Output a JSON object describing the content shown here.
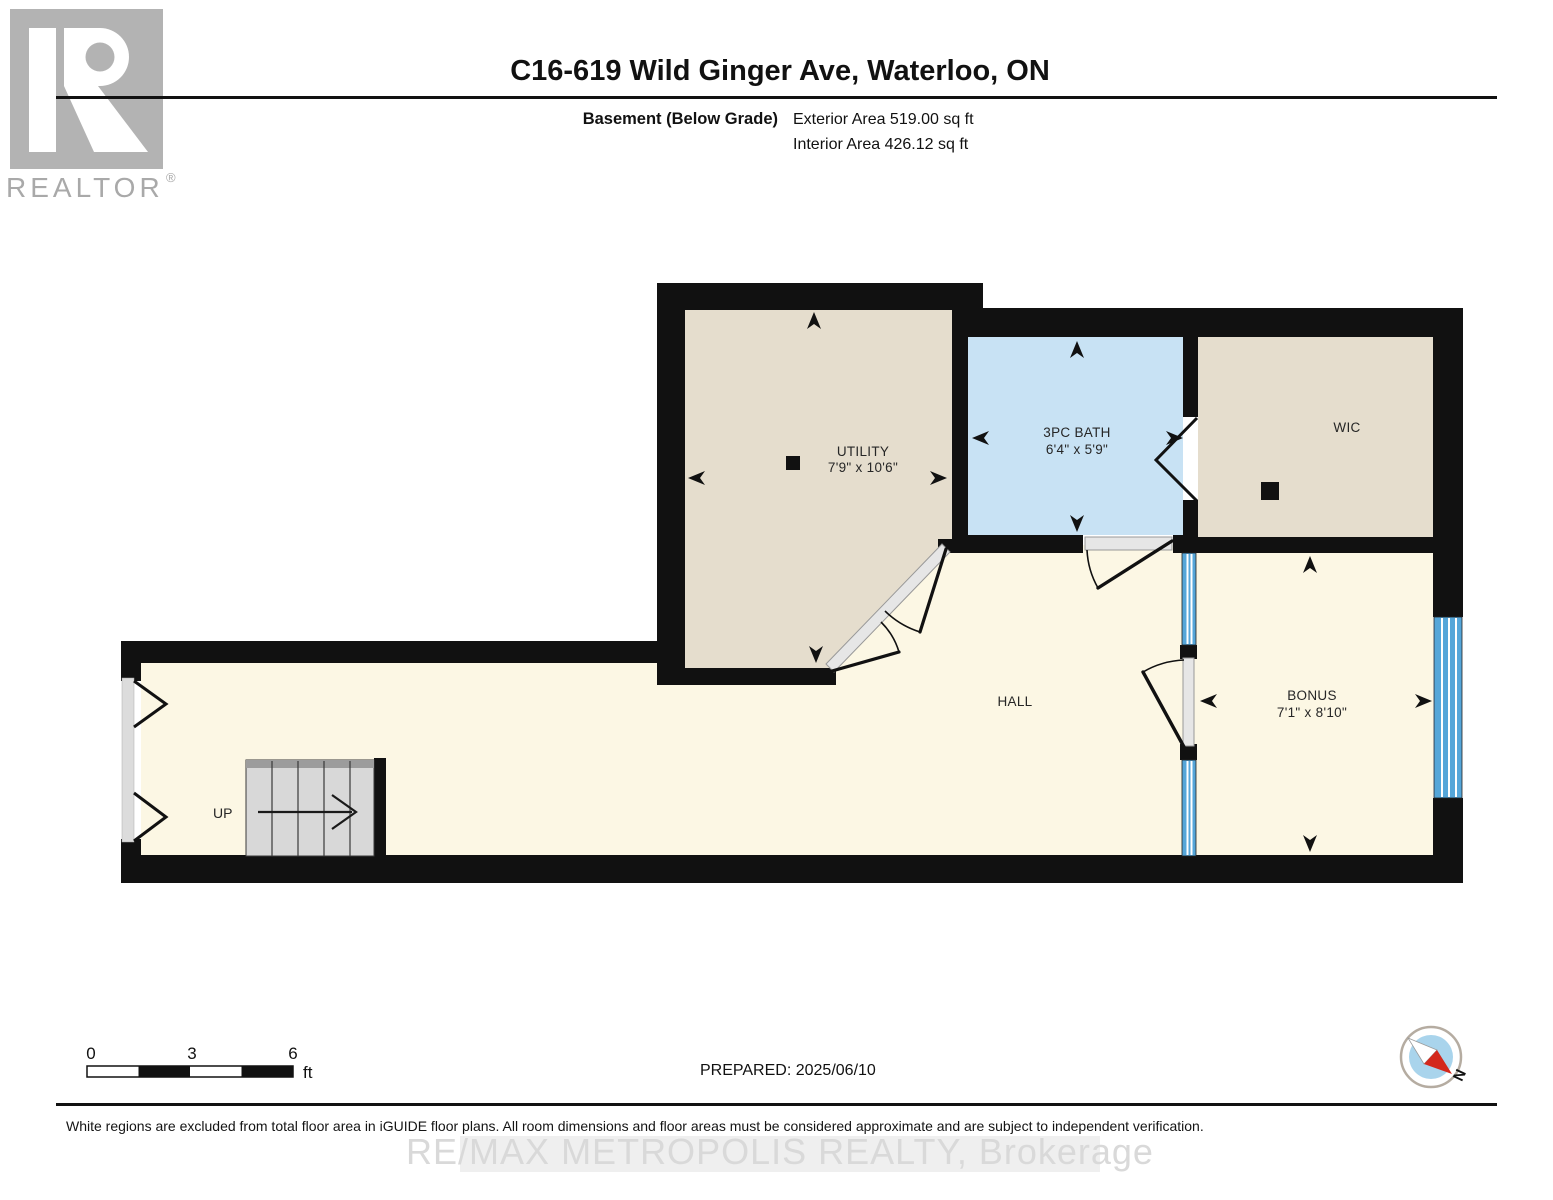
{
  "header": {
    "title": "C16-619 Wild Ginger Ave, Waterloo, ON",
    "floor_label": "Basement (Below Grade)",
    "exterior_area": "Exterior Area 519.00 sq ft",
    "interior_area": "Interior Area 426.12 sq ft"
  },
  "logo": {
    "text": "REALTOR",
    "registered": "®"
  },
  "rooms": [
    {
      "name": "UTILITY",
      "dims": "7'9\" x 10'6\""
    },
    {
      "name": "3PC BATH",
      "dims": "6'4\" x 5'9\""
    },
    {
      "name": "WIC"
    },
    {
      "name": "HALL"
    },
    {
      "name": "BONUS",
      "dims": "7'1\" x 8'10\""
    }
  ],
  "stairs": {
    "label": "UP"
  },
  "scale_bar": {
    "ticks": [
      "0",
      "3",
      "6"
    ],
    "unit": "ft"
  },
  "prepared": {
    "label": "PREPARED: 2025/06/10"
  },
  "compass": {
    "north_label": "N"
  },
  "footer": {
    "disclaimer": "White regions are excluded from total floor area in iGUIDE floor plans. All room dimensions and floor areas must be considered approximate and are subject to independent verification.",
    "watermark": "RE/MAX METROPOLIS REALTY, Brokerage"
  },
  "colors": {
    "wall": "#111111",
    "room_beige": "#e5ddcd",
    "room_blue": "#c8e2f4",
    "room_cream": "#fcf7e4",
    "window_blue": "#55a6d9",
    "stairs_gray": "#d8d8d8",
    "compass_red": "#d3281c",
    "logo_gray": "#b3b3b3",
    "watermark_gray": "#d9d9d9"
  }
}
